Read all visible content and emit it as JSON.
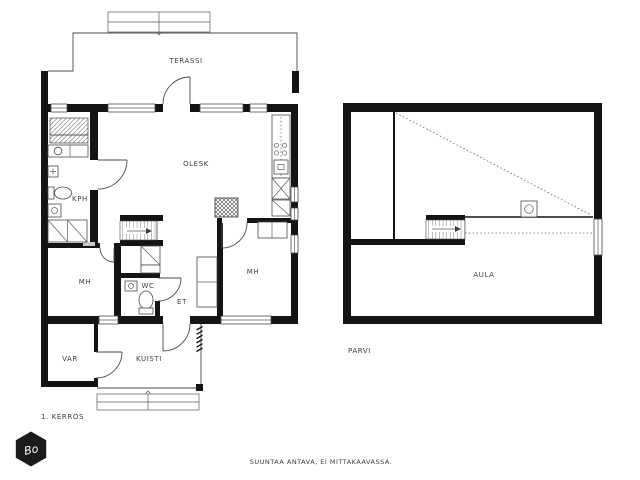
{
  "floors": {
    "first": {
      "label": "1. KERROS",
      "rooms": {
        "terassi": "TERASSI",
        "olesk": "OLESK",
        "kph": "KPH",
        "mh_left": "MH",
        "wc": "WC",
        "et": "ET",
        "mh_right": "MH",
        "kuisti": "KUISTI",
        "var": "VAR"
      }
    },
    "loft": {
      "label": "PARVI",
      "rooms": {
        "aula": "AULA"
      }
    }
  },
  "footer": {
    "disclaimer": "SUUNTAA ANTAVA, EI MITTAKAAVASSA."
  },
  "logo": {
    "monogram": "Bo"
  },
  "colors": {
    "wall": "#141414",
    "line": "#4a4a4a",
    "text": "#3c3c3c",
    "background": "#ffffff"
  }
}
